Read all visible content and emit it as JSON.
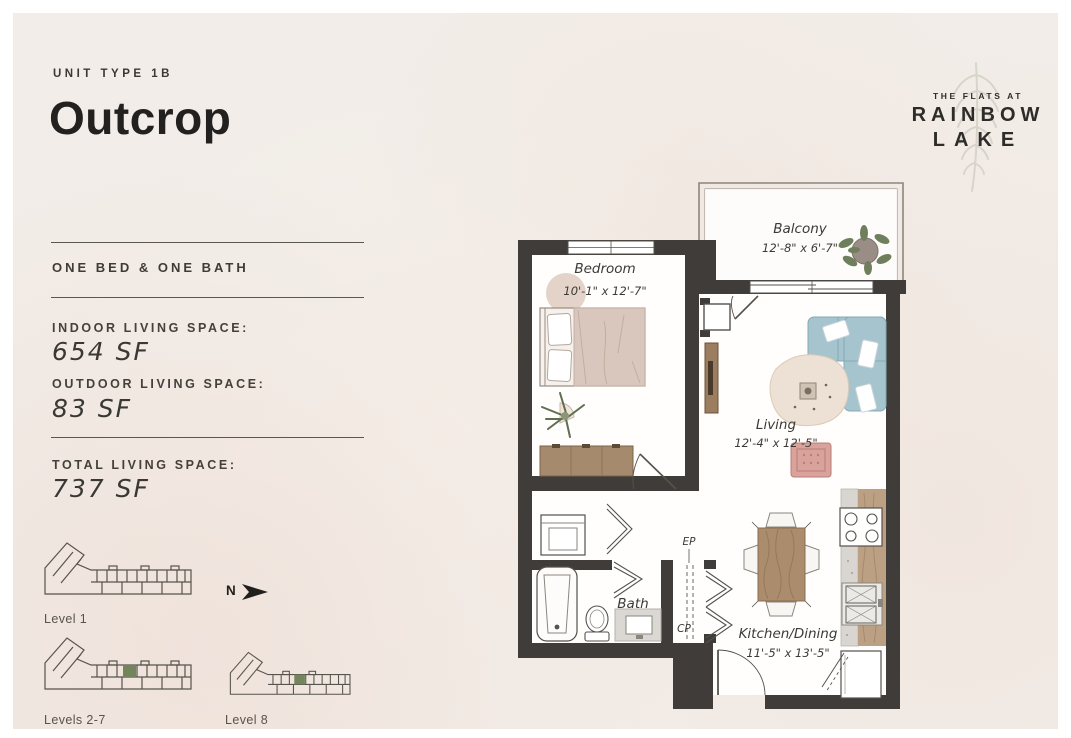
{
  "header": {
    "unit_type": "UNIT TYPE 1B",
    "unit_name": "Outcrop"
  },
  "logo": {
    "tagline": "THE FLATS AT",
    "line1": "RAINBOW",
    "line2": "LAKE"
  },
  "specs": {
    "config": "ONE BED & ONE BATH",
    "items": [
      {
        "label": "INDOOR LIVING SPACE:",
        "value": "654 SF"
      },
      {
        "label": "OUTDOOR LIVING SPACE:",
        "value": "83 SF"
      },
      {
        "label": "TOTAL LIVING SPACE:",
        "value": "737 SF"
      }
    ]
  },
  "levels": {
    "north_label": "N",
    "diagrams": [
      {
        "label": "Level 1",
        "highlight": false
      },
      {
        "label": "Levels 2-7",
        "highlight": true
      },
      {
        "label": "Level 8",
        "highlight": true
      }
    ]
  },
  "floorplan": {
    "balcony": {
      "name": "Balcony",
      "dims": "12'-8\" x 6'-7\""
    },
    "bedroom": {
      "name": "Bedroom",
      "dims": "10'-1\" x 12'-7\""
    },
    "living": {
      "name": "Living",
      "dims": "12'-4\" x 12'-5\""
    },
    "bath": {
      "name": "Bath"
    },
    "kitchen": {
      "name": "Kitchen/Dining",
      "dims": "11'-5\" x 13'-5\""
    },
    "ep": "EP",
    "cp": "CP"
  },
  "colors": {
    "background": "#f2ede8",
    "wall": "#403c39",
    "highlight_unit_green": "#74855c",
    "sofa_blue": "#a6c4ce",
    "armchair_rose": "#d9a29a",
    "wood": "#a58a6d",
    "text_dark": "#23211f"
  }
}
